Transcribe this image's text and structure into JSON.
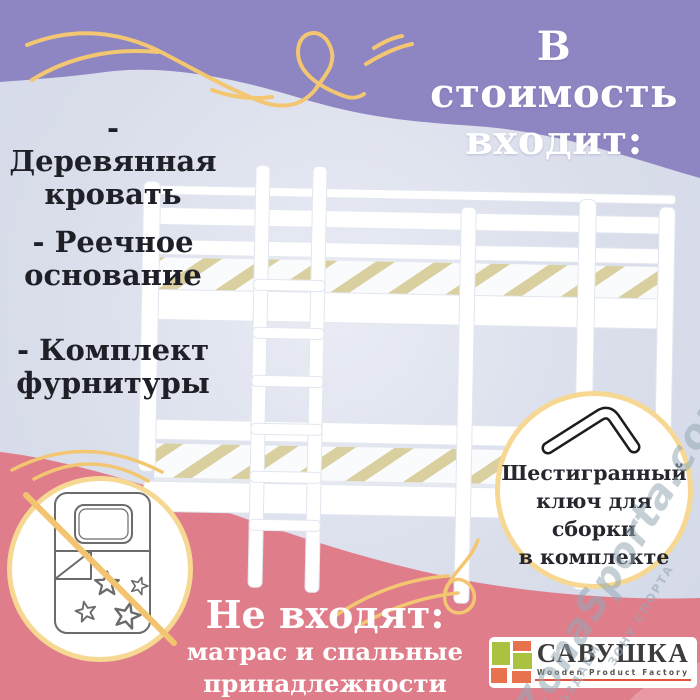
{
  "header": {
    "line1": "В стоимость",
    "line2": "входит:"
  },
  "includes": {
    "items": [
      {
        "lines": [
          "- Деревянная",
          "кровать"
        ]
      },
      {
        "lines": [
          "- Реечное",
          "основание"
        ]
      },
      {
        "lines": [
          "- Комплект",
          "фурнитуры"
        ]
      }
    ]
  },
  "hex_badge": {
    "icon": "hex-key-icon",
    "lines": [
      "Шестигранный",
      "ключ для",
      "сборки",
      "в комплекте"
    ]
  },
  "excludes": {
    "icon": "crossed-out-bedding-icon",
    "title": "Не входят:",
    "lines": [
      "матрас и спальные",
      "принадлежности"
    ]
  },
  "logo": {
    "brand": "САВУШКА",
    "tagline": "Wooden Product Factory"
  },
  "watermark": {
    "main": "ZonaSporta.com",
    "small_upper": "ЗОНУ СПОРТА",
    "small_lower": "СОЗДАЕМ"
  },
  "colors": {
    "purple_band": "#8e86c2",
    "lavender_bg": "#dadeeb",
    "pink_band": "#e07d8a",
    "swirl_yellow": "#f3c671",
    "badge_border_gold": "#f6d892",
    "dark_text": "#1f1f28",
    "logo_green": "#a9c23f",
    "logo_orange": "#e8724e",
    "slat_wood": "#d9cf9f"
  }
}
